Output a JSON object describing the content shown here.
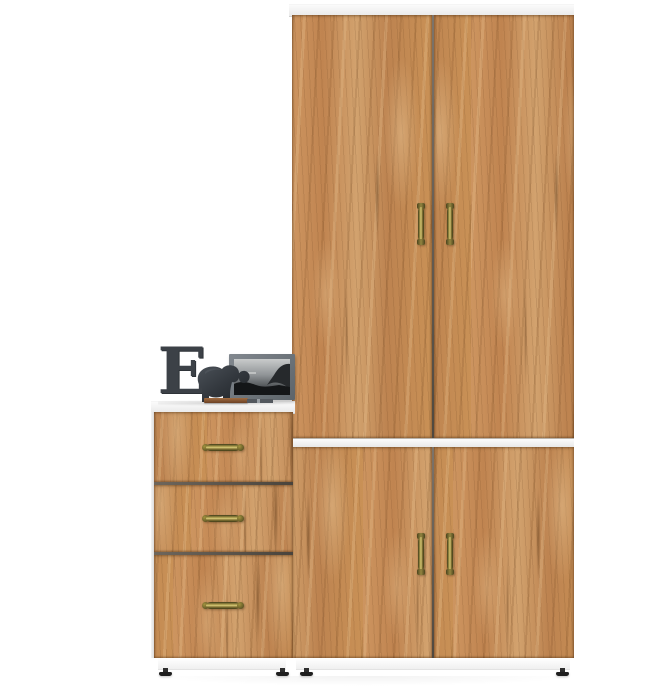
{
  "scene": {
    "type": "furniture product photo",
    "background_color": "#ffffff",
    "description": "Oak wardrobe set: tall two-door wardrobe over a two-door base cabinet, with a three-drawer chest on the left and decor on top"
  },
  "colors": {
    "wood_base": "#c68e58",
    "wood_light": "#d2a26e",
    "wood_dark": "#8e5e33",
    "carcass_white": "#f4f4f4",
    "door_gap": "#6b6157",
    "handle_brass": "#a99a4c",
    "handle_brass_dark": "#4a431d",
    "decor_dark": "#3c4147",
    "frame_gray": "#6b7278",
    "feet_black": "#1f1f1f"
  },
  "furniture": {
    "wardrobe_upper": {
      "label": "two-door wardrobe",
      "doors": 2,
      "handles": 2,
      "handle_style": "vertical antique brass"
    },
    "cabinet_lower": {
      "label": "two-door base cabinet",
      "doors": 2,
      "handles": 2,
      "handle_style": "vertical antique brass"
    },
    "drawer_unit": {
      "label": "three-drawer chest",
      "drawers": 3,
      "handles": 3,
      "handle_style": "horizontal antique brass"
    },
    "feet_count": 4
  },
  "decor": {
    "letter": "E",
    "items": [
      "letter-e",
      "elephant-figurine",
      "framed-black-and-white-photo",
      "wooden-tray"
    ]
  }
}
